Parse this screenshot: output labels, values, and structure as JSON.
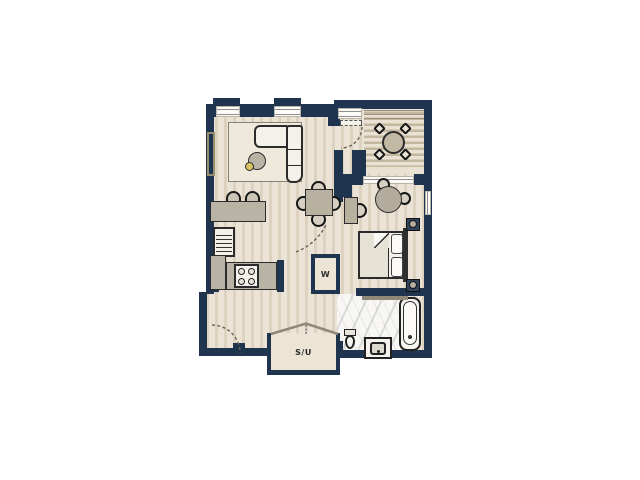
{
  "labels": {
    "washer": "W",
    "storage_utility": "S/U"
  },
  "colors": {
    "wall": "#1e344f",
    "floor_light": "#ebe4d6",
    "floor_stripe": "#ddd2c0",
    "deck_light": "#e9e2d2",
    "deck_stripe": "#c3b7a0",
    "furniture_gray": "#b9b3a5",
    "furniture_white": "#f4f1ea",
    "rug": "#efe9dc",
    "marble": "#f8f7f4",
    "outline": "#2b2b2b",
    "accent_table_dot": "#d8c266"
  }
}
